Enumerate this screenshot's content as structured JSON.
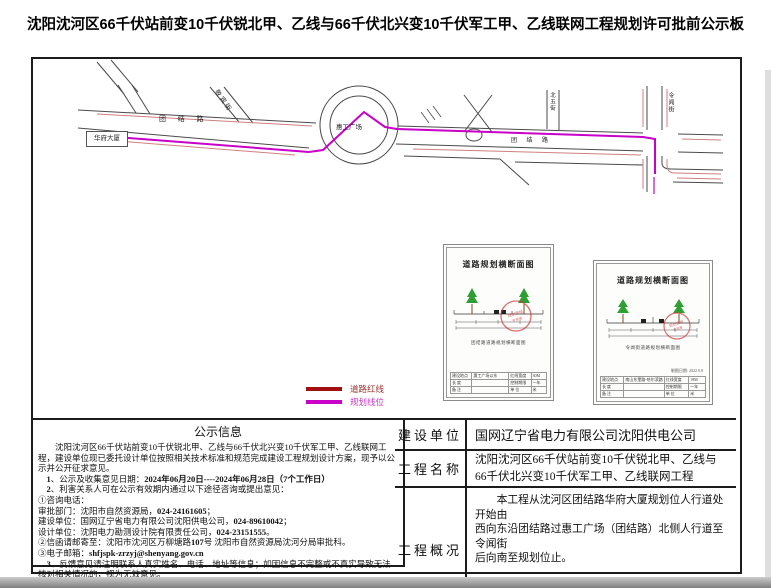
{
  "title": "沈阳沈河区66千伏站前变10千伏锐北甲、乙线与66千伏北兴变10千伏军工甲、乙线联网工程规划许可批前公示板",
  "map": {
    "colors": {
      "road": "#4a4a4a",
      "red_line": "#d07f7f",
      "plan_line": "#c800c8"
    },
    "labels": {
      "huafu_building": "华府大厦",
      "tuanjie_road_west": "团 结 路",
      "tuanjie_road_east": "团 结 路",
      "huigong_square": "惠工广场",
      "jingbin_street": "敬宾街",
      "beiwu_street": "北五街",
      "lingwen_street": "令闻街"
    },
    "legend": {
      "items": [
        {
          "label": "道路红线",
          "color": "#a01010",
          "text_color": "#a03030"
        },
        {
          "label": "规划线位",
          "color": "#c800c8",
          "text_color": "#c838c8"
        }
      ]
    },
    "insets": [
      {
        "title": "道路规划横断面图",
        "caption": "团结路道路规划横断面图",
        "date": "",
        "rows": [
          [
            "建设地点",
            "惠工广场以东",
            "红线宽度",
            "30M"
          ],
          [
            "长 度",
            "",
            "控制期限",
            "一年"
          ],
          [
            "备 注",
            "",
            "单 位",
            "米"
          ]
        ]
      },
      {
        "title": "道路规划横断面图",
        "caption": "令闻街道路规划横断面图",
        "date": "制图日期: 2022.9.8",
        "rows": [
          [
            "建设地点",
            "南山东堡路-哈尔滨路",
            "红线宽度",
            "19M"
          ],
          [
            "长 度",
            "",
            "控制期限",
            "一年"
          ],
          [
            "备 注",
            "",
            "单 位",
            "米"
          ]
        ]
      }
    ]
  },
  "notice": {
    "title": "公示信息",
    "lines": [
      {
        "indent": 2,
        "segments": [
          {
            "t": "沈阳沈河区66千伏站前变10千伏锐北甲、乙线与66千伏北兴变10千伏军工甲、乙线联网工程，建设单位现已委托设计单位按照相关技术标准和规范完成建设工程规划设计方案，现予以公示并公开征求意见。"
          }
        ]
      },
      {
        "indent": 1,
        "segments": [
          {
            "t": "1",
            "b": 1
          },
          {
            "t": "、公示及收集意见日期："
          },
          {
            "t": "2024年06月20日----2024年06月28日（7个工作日）",
            "b": 1
          }
        ]
      },
      {
        "indent": 1,
        "segments": [
          {
            "t": "2",
            "b": 1
          },
          {
            "t": "、利害关系人可在公示有效期内通过以下途径咨询或提出意见："
          }
        ]
      },
      {
        "indent": 0,
        "segments": [
          {
            "t": "①咨询电话："
          }
        ]
      },
      {
        "indent": 0,
        "segments": [
          {
            "t": "审批部门：沈阳市自然资源局，"
          },
          {
            "t": "024-24161605",
            "b": 1
          },
          {
            "t": "；"
          }
        ]
      },
      {
        "indent": 0,
        "segments": [
          {
            "t": "建设单位：国网辽宁省电力有限公司沈阳供电公司，"
          },
          {
            "t": "024-89610042",
            "b": 1
          },
          {
            "t": "；"
          }
        ]
      },
      {
        "indent": 0,
        "segments": [
          {
            "t": "设计单位：沈阳电力勘测设计院有限责任公司，"
          },
          {
            "t": "024-23151555",
            "b": 1
          },
          {
            "t": "。"
          }
        ]
      },
      {
        "indent": 0,
        "segments": [
          {
            "t": "②信函请邮寄至：沈阳市沈河区万柳塘路"
          },
          {
            "t": "107",
            "b": 1
          },
          {
            "t": "号 沈阳市自然资源局沈河分局审批科。"
          }
        ]
      },
      {
        "indent": 0,
        "segments": [
          {
            "t": "③电子邮箱："
          },
          {
            "t": "shfjspk-zrzyj@shenyang.gov.cn",
            "b": 1
          }
        ]
      },
      {
        "indent": 1,
        "segments": [
          {
            "t": "3",
            "b": 1
          },
          {
            "t": "、反馈意见请注明联系人真实姓名、电话、地址等信息；如因信息不完整或不真实导致无法核对相关情况的，视为无效意见。"
          }
        ]
      },
      {
        "indent": 1,
        "segments": [
          {
            "t": "4",
            "b": 1
          },
          {
            "t": "、本方案涉及的利害关系人依法享有听证权。"
          }
        ]
      }
    ]
  },
  "info_table": {
    "rows": [
      {
        "label": "建设单位",
        "value": "国网辽宁省电力有限公司沈阳供电公司"
      },
      {
        "label": "工程名称",
        "value": "沈阳沈河区66千伏站前变10千伏锐北甲、乙线与\n66千伏北兴变10千伏军工甲、乙线联网工程"
      },
      {
        "label": "工程概况",
        "value": "　　本工程从沈河区团结路华府大厦规划位人行道处开始由\n西向东沿团结路过惠工广场（团结路）北侧人行道至令闻街\n后向南至规划位止。\n\n路径全长：1425米。新建8孔（φ150）混凝土排管沟。"
      }
    ]
  }
}
